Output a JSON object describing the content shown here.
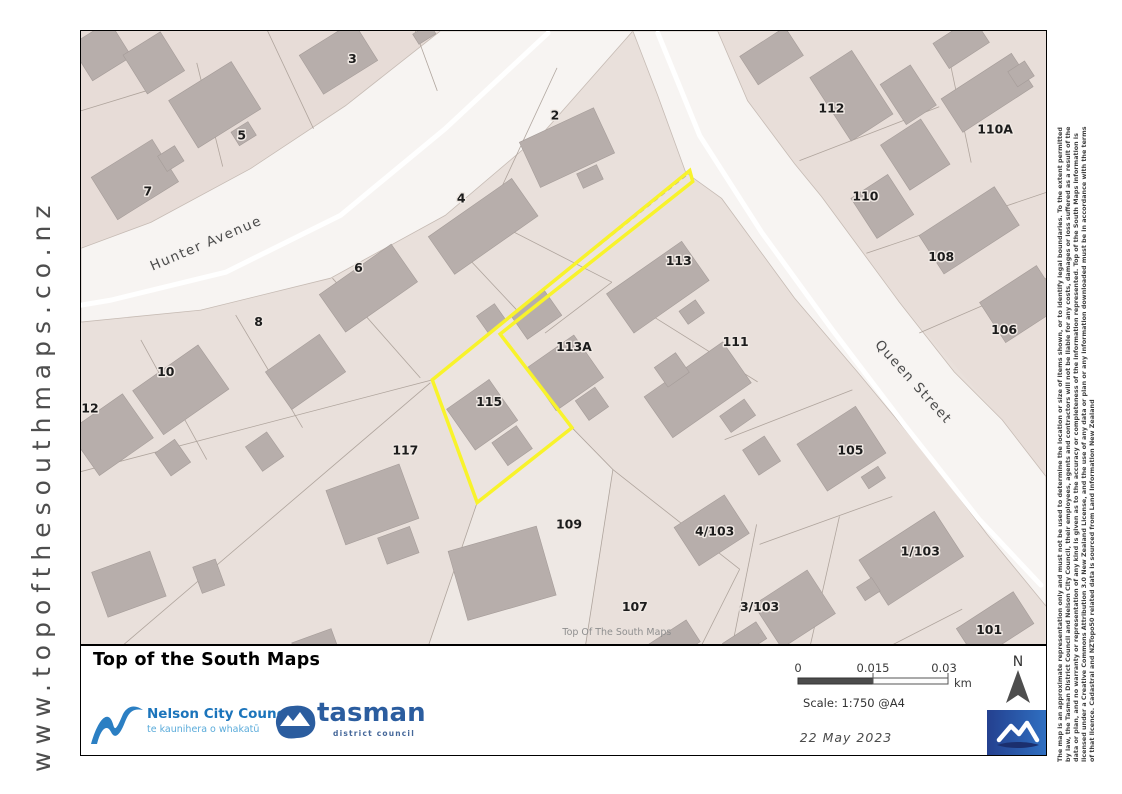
{
  "banner": {
    "url_text": "www.topofthesouthmaps.co.nz"
  },
  "disclaimer": {
    "lines": [
      "The map is an approximate representation only and must not be used to determine the location or size of items shown, or to identify legal boundaries. To the extent permitted",
      "by law, the Tasman District Council and Nelson City Council, their employees, agents and contractors will not be liable for any costs, damages or loss suffered as a result of the",
      "data or plan, and no warranty or representation of any kind is given as to the accuracy or completeness of the information represented. Top of the South Maps information is",
      "licensed under a Creative Commons Attribution 3.0 New Zealand License, and the use of any data or plan or any information downloaded must be in accordance with the terms",
      "of that licence. Cadastral and NZTopo50 related data is sourced from Land Information New Zealand"
    ]
  },
  "map": {
    "highlight_color": "#f8f32b",
    "street_labels": [
      {
        "text": "Hunter Avenue",
        "x": 207,
        "y": 247,
        "rot": -23
      },
      {
        "text": "Queen Street",
        "x": 911,
        "y": 385,
        "rot": 48
      }
    ],
    "parcel_labels": [
      {
        "t": "3",
        "x": 352,
        "y": 62
      },
      {
        "t": "5",
        "x": 241,
        "y": 139
      },
      {
        "t": "7",
        "x": 147,
        "y": 195
      },
      {
        "t": "2",
        "x": 555,
        "y": 119
      },
      {
        "t": "4",
        "x": 461,
        "y": 202
      },
      {
        "t": "6",
        "x": 358,
        "y": 272
      },
      {
        "t": "8",
        "x": 258,
        "y": 326
      },
      {
        "t": "10",
        "x": 165,
        "y": 376
      },
      {
        "t": "12",
        "x": 89,
        "y": 413
      },
      {
        "t": "117",
        "x": 405,
        "y": 455
      },
      {
        "t": "115",
        "x": 489,
        "y": 406
      },
      {
        "t": "113A",
        "x": 574,
        "y": 351
      },
      {
        "t": "113",
        "x": 679,
        "y": 265
      },
      {
        "t": "111",
        "x": 736,
        "y": 346
      },
      {
        "t": "112",
        "x": 832,
        "y": 112
      },
      {
        "t": "110",
        "x": 866,
        "y": 200
      },
      {
        "t": "110A",
        "x": 996,
        "y": 133
      },
      {
        "t": "108",
        "x": 942,
        "y": 261
      },
      {
        "t": "106",
        "x": 1005,
        "y": 334
      },
      {
        "t": "105",
        "x": 851,
        "y": 455
      },
      {
        "t": "4/103",
        "x": 715,
        "y": 536
      },
      {
        "t": "1/103",
        "x": 921,
        "y": 556
      },
      {
        "t": "3/103",
        "x": 760,
        "y": 612
      },
      {
        "t": "107",
        "x": 635,
        "y": 612
      },
      {
        "t": "109",
        "x": 569,
        "y": 529
      },
      {
        "t": "101",
        "x": 990,
        "y": 635
      }
    ],
    "watermark": {
      "text": "Top Of The South Maps",
      "x": 617,
      "y": 636
    }
  },
  "footer": {
    "title": "Top of the South Maps",
    "nelson_name": "Nelson City Council",
    "nelson_tagline": "te kaunihera o whakatū",
    "tasman_name": "tasman",
    "tasman_sub": "district council",
    "scale_labels": {
      "zero": "0",
      "mid": "0.015",
      "end": "0.03",
      "unit": "km"
    },
    "scale_text": "Scale: 1:750 @A4",
    "date_text": "22 May 2023",
    "north_label": "N"
  }
}
